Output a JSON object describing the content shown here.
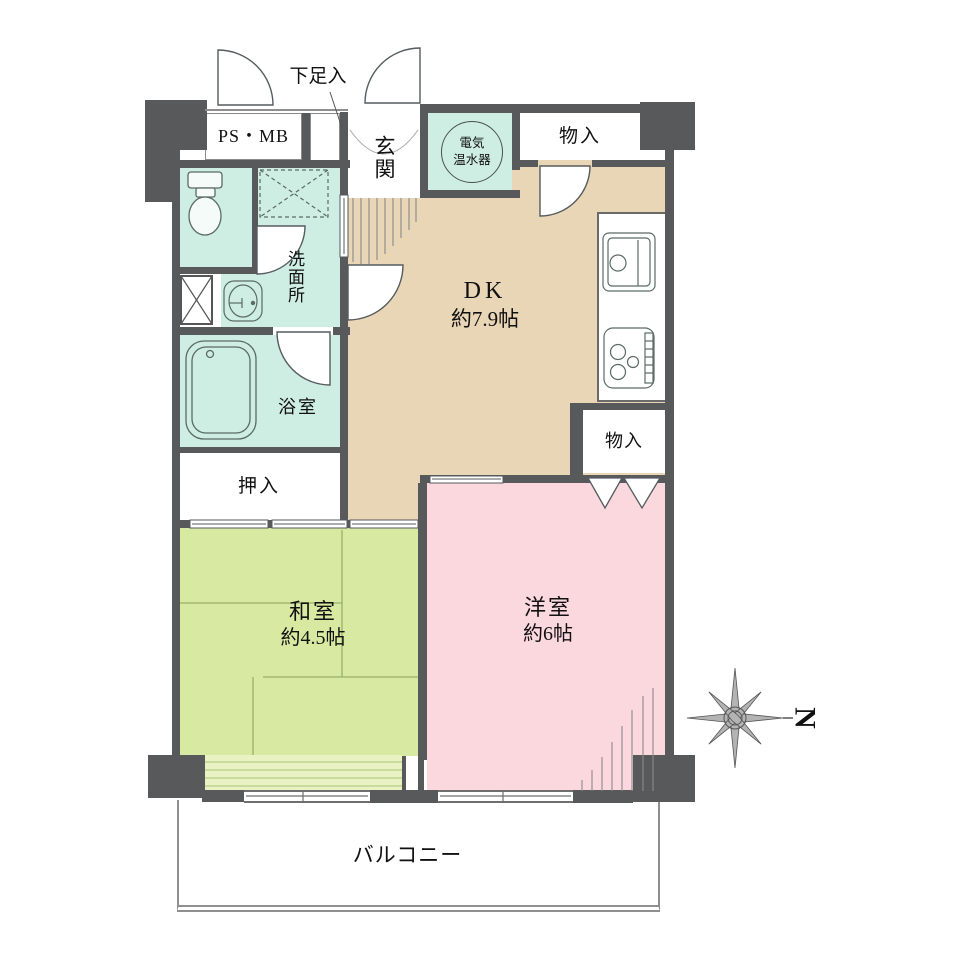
{
  "colors": {
    "wall": "#58595b",
    "teal": "#cfeee3",
    "beige": "#e9d6b6",
    "green": "#d8e9a2",
    "green_light": "#e8f2c2",
    "pink": "#fbd7de",
    "line": "#555b5e"
  },
  "labels": {
    "ps_mb": "PS・MB",
    "shoe_cabinet": "下足入",
    "entrance": "玄関",
    "water_heater_line1": "電気",
    "water_heater_line2": "温水器",
    "storage_top": "物入",
    "washroom": "洗面所",
    "bathroom": "浴室",
    "closet": "押入",
    "dk_name": "DK",
    "dk_size": "約7.9帖",
    "storage_dk": "物入",
    "japanese_room_name": "和室",
    "japanese_room_size": "約4.5帖",
    "western_room_name": "洋室",
    "western_room_size": "約6帖",
    "balcony": "バルコニー"
  },
  "compass": {
    "label": "N"
  }
}
